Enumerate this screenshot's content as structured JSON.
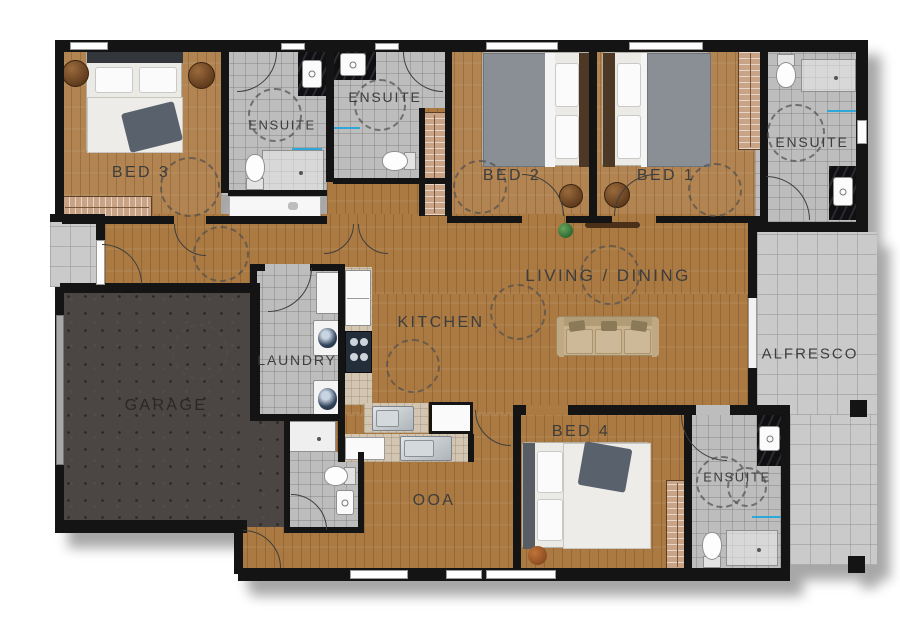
{
  "rooms": {
    "bed3": {
      "label": "BED 3"
    },
    "ensuite_bed3": {
      "label": "ENSUITE"
    },
    "ensuite_bed2": {
      "label": "ENSUITE"
    },
    "bed2": {
      "label": "BED 2"
    },
    "bed1": {
      "label": "BED 1"
    },
    "ensuite_bed1": {
      "label": "ENSUITE"
    },
    "living_dining": {
      "label": "LIVING / DINING"
    },
    "kitchen": {
      "label": "KITCHEN"
    },
    "laundry": {
      "label": "LAUNDRY"
    },
    "garage": {
      "label": "GARAGE"
    },
    "alfresco": {
      "label": "ALFRESCO"
    },
    "bed4": {
      "label": "BED 4"
    },
    "ensuite_bed4": {
      "label": "ENSUITE"
    },
    "ooa": {
      "label": "OOA"
    }
  },
  "colors": {
    "wall": "#141414",
    "wood_floor": "#aa7a42",
    "bedroom_wood": "#b28451",
    "bathroom_tile": "#bdbdbd",
    "alfresco_tile": "#cacaca",
    "garage_floor": "#4b4543",
    "kitchen_bench": "#d2c6b2",
    "wardrobe": "#c9a386",
    "towel_rail": "#2fa8d8",
    "label_text": "#3d3d3d"
  }
}
